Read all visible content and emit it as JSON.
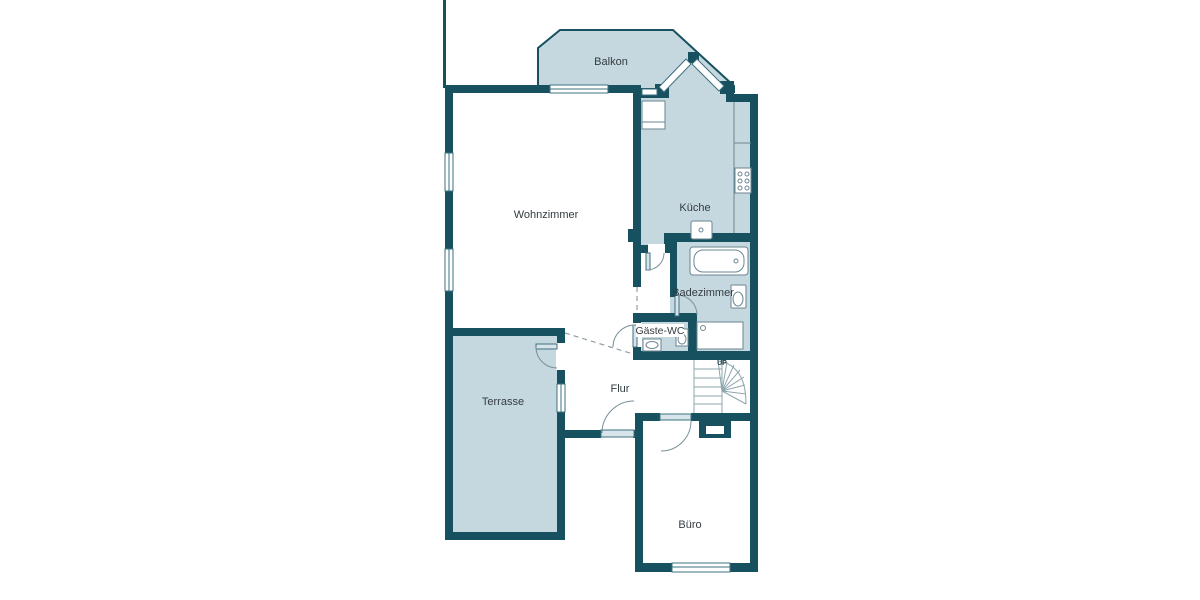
{
  "floorplan": {
    "rooms": {
      "balkon": {
        "label": "Balkon",
        "filled": true
      },
      "wohnzimmer": {
        "label": "Wohnzimmer",
        "filled": false
      },
      "kueche": {
        "label": "Küche",
        "filled": true
      },
      "badezimmer": {
        "label": "Badezimmer",
        "filled": true
      },
      "gaeste_wc": {
        "label": "Gäste-WC",
        "filled": true
      },
      "flur": {
        "label": "Flur",
        "filled": false
      },
      "terrasse": {
        "label": "Terrasse",
        "filled": true
      },
      "buero": {
        "label": "Büro",
        "filled": false
      }
    },
    "stairs": {
      "direction_label": "UP"
    },
    "colors": {
      "wall": "#175160",
      "room_fill": "#c6d8df",
      "background": "#ffffff",
      "label_text": "#333c40",
      "door_leaf": "#d7e4e9"
    },
    "fixtures": {
      "kueche": [
        "fridge-icon",
        "counter",
        "stove-icon",
        "sink-icon"
      ],
      "badezimmer": [
        "bathtub-icon",
        "toilet-icon",
        "shower-icon"
      ],
      "gaeste_wc": [
        "sink-icon",
        "toilet-icon"
      ]
    }
  }
}
